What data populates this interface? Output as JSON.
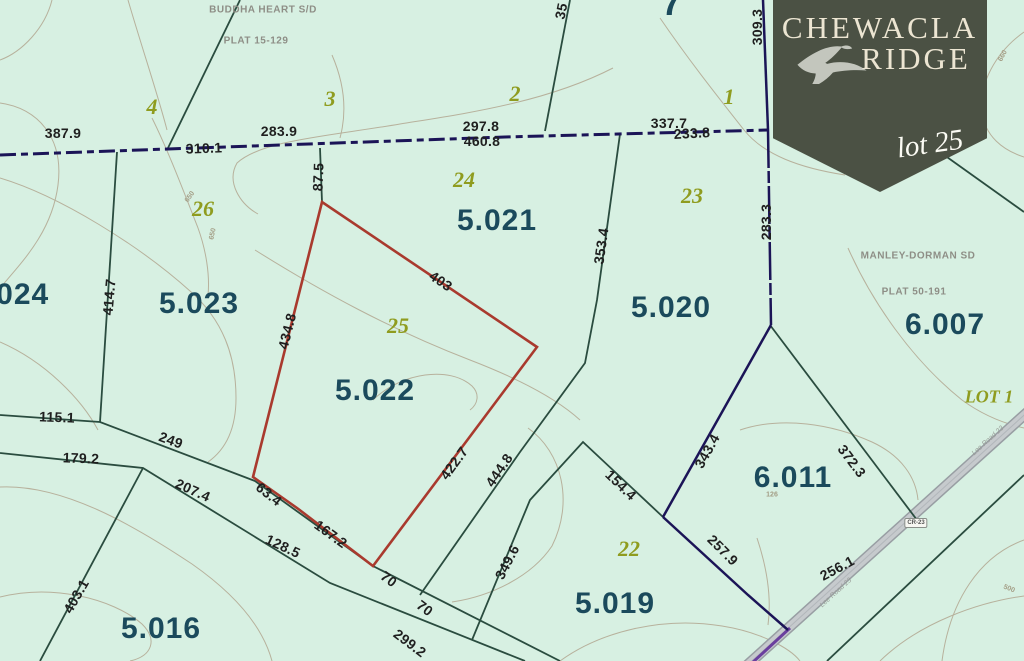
{
  "map": {
    "badge": {
      "line1": "CHEWACLA",
      "line2": "RIDGE",
      "lot_label": "lot 25",
      "bird_icon": "hawk-silhouette"
    },
    "subdivision_labels": [
      {
        "text": "BUDDHA HEART S/D",
        "x": 263,
        "y": 10
      },
      {
        "text": "PLAT 15-129",
        "x": 256,
        "y": 41
      },
      {
        "text": "MANLEY-DORMAN SD",
        "x": 918,
        "y": 256
      },
      {
        "text": "PLAT 50-191",
        "x": 914,
        "y": 292
      }
    ],
    "parcel_ids": [
      {
        "text": ".024",
        "x": 18,
        "y": 295
      },
      {
        "text": "5.023",
        "x": 199,
        "y": 304
      },
      {
        "text": "5.021",
        "x": 497,
        "y": 221
      },
      {
        "text": "5.020",
        "x": 671,
        "y": 308
      },
      {
        "text": "5.022",
        "x": 375,
        "y": 391
      },
      {
        "text": "6.007",
        "x": 945,
        "y": 325
      },
      {
        "text": "6.011",
        "x": 793,
        "y": 478
      },
      {
        "text": "5.016",
        "x": 161,
        "y": 629
      },
      {
        "text": "5.019",
        "x": 615,
        "y": 604
      },
      {
        "text": "7",
        "x": 672,
        "y": 3,
        "fs": 36
      }
    ],
    "lot_numbers": [
      {
        "text": "4",
        "x": 152,
        "y": 107
      },
      {
        "text": "3",
        "x": 330,
        "y": 99
      },
      {
        "text": "2",
        "x": 515,
        "y": 94
      },
      {
        "text": "1",
        "x": 729,
        "y": 97
      },
      {
        "text": "26",
        "x": 203,
        "y": 209
      },
      {
        "text": "24",
        "x": 464,
        "y": 180
      },
      {
        "text": "23",
        "x": 692,
        "y": 196
      },
      {
        "text": "25",
        "x": 398,
        "y": 326
      },
      {
        "text": "22",
        "x": 629,
        "y": 549
      },
      {
        "text": "LOT 1",
        "x": 989,
        "y": 397,
        "fs": 18
      }
    ],
    "dimension_labels": [
      {
        "text": "387.9",
        "x": 63,
        "y": 133,
        "r": 0
      },
      {
        "text": "310.1",
        "x": 204,
        "y": 148,
        "r": -2
      },
      {
        "text": "283.9",
        "x": 279,
        "y": 131,
        "r": 0
      },
      {
        "text": "297.8",
        "x": 481,
        "y": 126,
        "r": 0
      },
      {
        "text": "460.8",
        "x": 482,
        "y": 141,
        "r": 0
      },
      {
        "text": "337.7",
        "x": 669,
        "y": 123,
        "r": 0
      },
      {
        "text": "233.8",
        "x": 692,
        "y": 133,
        "r": -3
      },
      {
        "text": "309.3",
        "x": 757,
        "y": 27,
        "r": -90
      },
      {
        "text": "35",
        "x": 561,
        "y": 11,
        "r": -78
      },
      {
        "text": "87.5",
        "x": 318,
        "y": 177,
        "r": -88
      },
      {
        "text": "283.3",
        "x": 766,
        "y": 222,
        "r": -90
      },
      {
        "text": "414.7",
        "x": 109,
        "y": 297,
        "r": -85
      },
      {
        "text": "353.4",
        "x": 601,
        "y": 246,
        "r": -82
      },
      {
        "text": "434.8",
        "x": 287,
        "y": 331,
        "r": -76
      },
      {
        "text": "403",
        "x": 441,
        "y": 281,
        "r": 34
      },
      {
        "text": "422.7",
        "x": 454,
        "y": 463,
        "r": -54
      },
      {
        "text": "63.4",
        "x": 269,
        "y": 494,
        "r": 38
      },
      {
        "text": "167.2",
        "x": 331,
        "y": 534,
        "r": 36
      },
      {
        "text": "70",
        "x": 389,
        "y": 579,
        "r": 37
      },
      {
        "text": "70",
        "x": 425,
        "y": 608,
        "r": 37
      },
      {
        "text": "299.2",
        "x": 410,
        "y": 643,
        "r": 37
      },
      {
        "text": "128.5",
        "x": 283,
        "y": 546,
        "r": 25
      },
      {
        "text": "444.8",
        "x": 499,
        "y": 470,
        "r": -56
      },
      {
        "text": "349.6",
        "x": 507,
        "y": 562,
        "r": -63
      },
      {
        "text": "154.4",
        "x": 621,
        "y": 485,
        "r": 44
      },
      {
        "text": "343.4",
        "x": 707,
        "y": 451,
        "r": -61
      },
      {
        "text": "257.9",
        "x": 723,
        "y": 550,
        "r": 45
      },
      {
        "text": "372.3",
        "x": 852,
        "y": 461,
        "r": 53
      },
      {
        "text": "256.1",
        "x": 837,
        "y": 568,
        "r": -28
      },
      {
        "text": "115.1",
        "x": 57,
        "y": 417,
        "r": 2
      },
      {
        "text": "249",
        "x": 171,
        "y": 440,
        "r": 20
      },
      {
        "text": "179.2",
        "x": 81,
        "y": 458,
        "r": 2
      },
      {
        "text": "207.4",
        "x": 193,
        "y": 490,
        "r": 24
      },
      {
        "text": "403.1",
        "x": 76,
        "y": 596,
        "r": -60
      }
    ],
    "contour_elevations": [
      {
        "text": "650",
        "x": 190,
        "y": 197,
        "r": -55
      },
      {
        "text": "650",
        "x": 213,
        "y": 234,
        "r": -78
      },
      {
        "text": "660",
        "x": 1003,
        "y": 56,
        "r": -62
      },
      {
        "text": "500",
        "x": 1009,
        "y": 589,
        "r": 22
      },
      {
        "text": "126",
        "x": 772,
        "y": 495,
        "r": 0
      }
    ],
    "road": {
      "shield": "CR-23",
      "shield_pos": {
        "x": 916,
        "y": 523
      },
      "name": "Lee Road 23",
      "name_labels": [
        {
          "x": 988,
          "y": 441,
          "r": -42
        },
        {
          "x": 836,
          "y": 593,
          "r": -42
        }
      ]
    },
    "colors": {
      "background": "#d7f0e2",
      "parcel_id_text": "#1b4a5c",
      "lot_number_text": "#8f9c1f",
      "dimension_text": "#1f1f1f",
      "boundary_navy": "#1b1457",
      "parcel_line_green": "#2a4c3f",
      "highlight_parcel_red": "#a93a2e",
      "contour_line": "#b7b19c",
      "road_fill": "#c6cacd",
      "road_casing": "#989ea3",
      "road_edge_purple": "#6a3f9e",
      "badge_background": "#4b5144",
      "badge_text": "#ece5d2"
    }
  }
}
